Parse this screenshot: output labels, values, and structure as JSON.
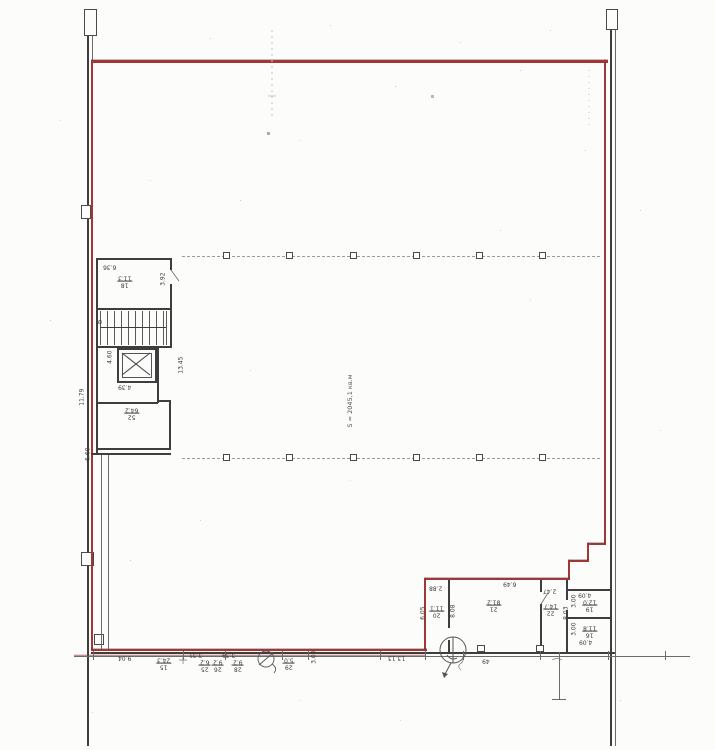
{
  "drawing": {
    "area_label": "S = 2045,1 кв.м",
    "stair_label": "Б"
  },
  "left_block": {
    "dim_636": "6.36",
    "room18": {
      "num": "18",
      "area": "11.3"
    },
    "dim_392": "3.92",
    "dim_460": "4.60",
    "dim_439": "4.39",
    "dim_1179": "11.79",
    "dim_1345": "13.45",
    "room52": {
      "num": "52",
      "area": "64.2"
    },
    "dim_660": "6.60"
  },
  "right_block": {
    "dim_288": "2.88",
    "dim_649": "6.49",
    "dim_247": "2.47",
    "room20": {
      "num": "20",
      "area": "11.1"
    },
    "room21": {
      "num": "21",
      "area": "81.2"
    },
    "room22": {
      "num": "22",
      "area": "14.7"
    },
    "room19": {
      "num": "19",
      "area": "12.0"
    },
    "room16": {
      "num": "16",
      "area": "11.8"
    },
    "dim_605": "6.05",
    "dim_808": "8.08",
    "dim_803": "8.03",
    "dim_300a": "3.00",
    "dim_300b": "3.00",
    "dim_409a": "4.09",
    "dim_409b": "4.09"
  },
  "bottom_row": {
    "dim_904": "9.04",
    "room15": {
      "num": "15",
      "area": "24.3"
    },
    "dim_331": "3.31",
    "room25": {
      "num": "25",
      "area": "6.2"
    },
    "room26": {
      "num": "26",
      "area": "9.2"
    },
    "dim_339": "3.39",
    "room28": {
      "num": "28",
      "area": "9.2"
    },
    "room29": {
      "num": "29",
      "area": "5.0"
    },
    "dim_300": "3.00",
    "dim_1313": "13.13",
    "mark_49": "49"
  }
}
